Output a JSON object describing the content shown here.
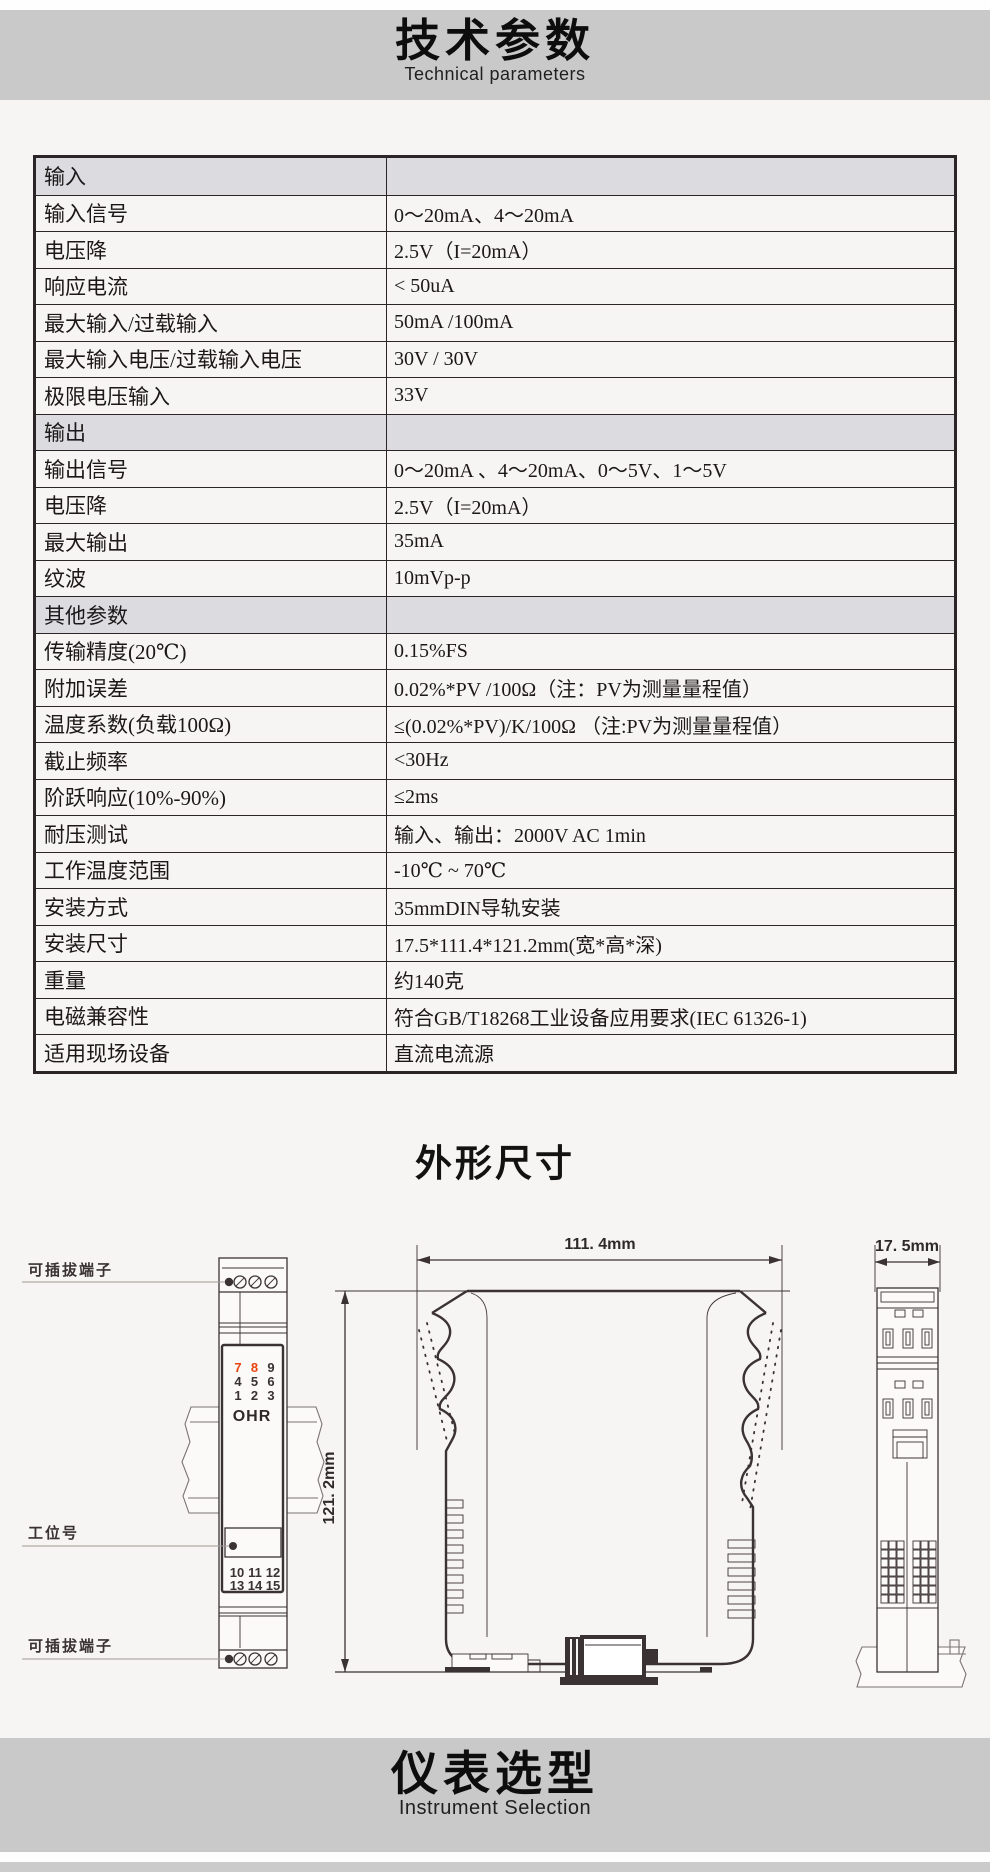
{
  "colors": {
    "band_gray": "#c9c9c9",
    "page_bg": "#f6f5f3",
    "section_row_bg": "#dcdce0",
    "table_border": "#2c2527",
    "text_dark": "#1c1819",
    "line_dark": "#3b3234",
    "terminal_red": "#e8430f"
  },
  "header": {
    "title": "技术参数",
    "subtitle": "Technical parameters"
  },
  "spec_table": {
    "rows": [
      {
        "type": "section",
        "label": "输入",
        "value": ""
      },
      {
        "type": "data",
        "label": "输入信号",
        "value": "0～20mA、4～20mA"
      },
      {
        "type": "data",
        "label": "电压降",
        "value": "2.5V（I=20mA）"
      },
      {
        "type": "data",
        "label": "响应电流",
        "value": "< 50uA"
      },
      {
        "type": "data",
        "label": "最大输入/过载输入",
        "value": "50mA /100mA"
      },
      {
        "type": "data",
        "label": "最大输入电压/过载输入电压",
        "value": "30V / 30V"
      },
      {
        "type": "data",
        "label": "极限电压输入",
        "value": "33V"
      },
      {
        "type": "section",
        "label": "输出",
        "value": ""
      },
      {
        "type": "data",
        "label": "输出信号",
        "value": "0～20mA 、4～20mA、0～5V、1～5V"
      },
      {
        "type": "data",
        "label": "电压降",
        "value": "2.5V（I=20mA）"
      },
      {
        "type": "data",
        "label": "最大输出",
        "value": "35mA"
      },
      {
        "type": "data",
        "label": "纹波",
        "value": "10mVp-p"
      },
      {
        "type": "section",
        "label": "其他参数",
        "value": ""
      },
      {
        "type": "data",
        "label": "传输精度(20℃)",
        "value": "0.15%FS"
      },
      {
        "type": "data",
        "label": "附加误差",
        "value": "0.02%*PV /100Ω（注：PV为测量量程值）"
      },
      {
        "type": "data",
        "label": "温度系数(负载100Ω)",
        "value": "≤(0.02%*PV)/K/100Ω （注:PV为测量量程值）"
      },
      {
        "type": "data",
        "label": "截止频率",
        "value": "<30Hz"
      },
      {
        "type": "data",
        "label": "阶跃响应(10%-90%)",
        "value": "≤2ms"
      },
      {
        "type": "data",
        "label": "耐压测试",
        "value": "输入、输出：2000V AC  1min"
      },
      {
        "type": "data",
        "label": "工作温度范围",
        "value": "-10℃ ~ 70℃"
      },
      {
        "type": "data",
        "label": "安装方式",
        "value": "35mmDIN导轨安装"
      },
      {
        "type": "data",
        "label": "安装尺寸",
        "value": "17.5*111.4*121.2mm(宽*高*深)"
      },
      {
        "type": "data",
        "label": "重量",
        "value": "约140克"
      },
      {
        "type": "data",
        "label": "电磁兼容性",
        "value": "符合GB/T18268工业设备应用要求(IEC 61326-1)"
      },
      {
        "type": "data",
        "label": "适用现场设备",
        "value": "直流电流源"
      }
    ]
  },
  "dimensions_section": {
    "title": "外形尺寸",
    "labels": {
      "pluggable_terminal_top": "可插拔端子",
      "station_number": "工位号",
      "pluggable_terminal_bottom": "可插拔端子"
    },
    "dims": {
      "width": "111. 4mm",
      "height": "121. 2mm",
      "depth": "17. 5mm"
    },
    "front_view": {
      "brand": "OHR",
      "terminals_top": [
        [
          "7",
          "8",
          "9"
        ],
        [
          "4",
          "5",
          "6"
        ],
        [
          "1",
          "2",
          "3"
        ]
      ],
      "terminals_bottom": [
        [
          "10",
          "11",
          "12"
        ],
        [
          "13",
          "14",
          "15"
        ]
      ],
      "red_terminals": [
        "7",
        "8"
      ]
    }
  },
  "selection_section": {
    "title": "仪表选型",
    "subtitle": "Instrument Selection"
  }
}
